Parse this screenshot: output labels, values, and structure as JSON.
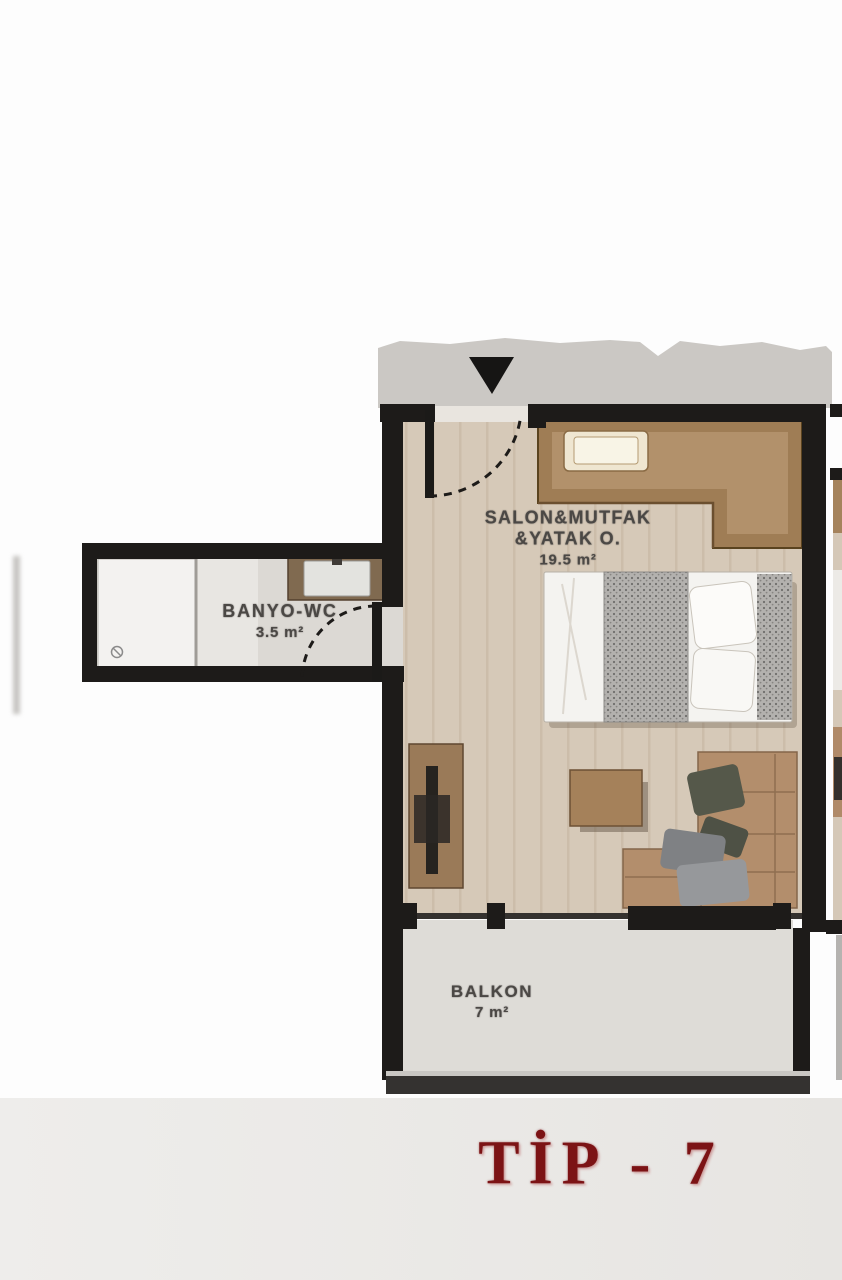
{
  "title": {
    "text": "TİP - 7"
  },
  "rooms": {
    "living": {
      "name": "SALON&MUTFAK",
      "name2": "&YATAK O.",
      "area": "19.5 m²"
    },
    "bath": {
      "name": "BANYO-WC",
      "area": "3.5 m²"
    },
    "balcony": {
      "name": "BALKON",
      "area": "7 m²"
    }
  },
  "icons": {
    "entrance": "entrance-arrow"
  },
  "colors": {
    "accent_red": "#7c1315",
    "wall": "#1d1b19",
    "wood_floor": "#d6c9b8",
    "counter": "#9f7d55",
    "bath_floor": "#dcd9d4",
    "balcony_floor": "#dedcd7",
    "page_band": "#e9e7e4"
  }
}
